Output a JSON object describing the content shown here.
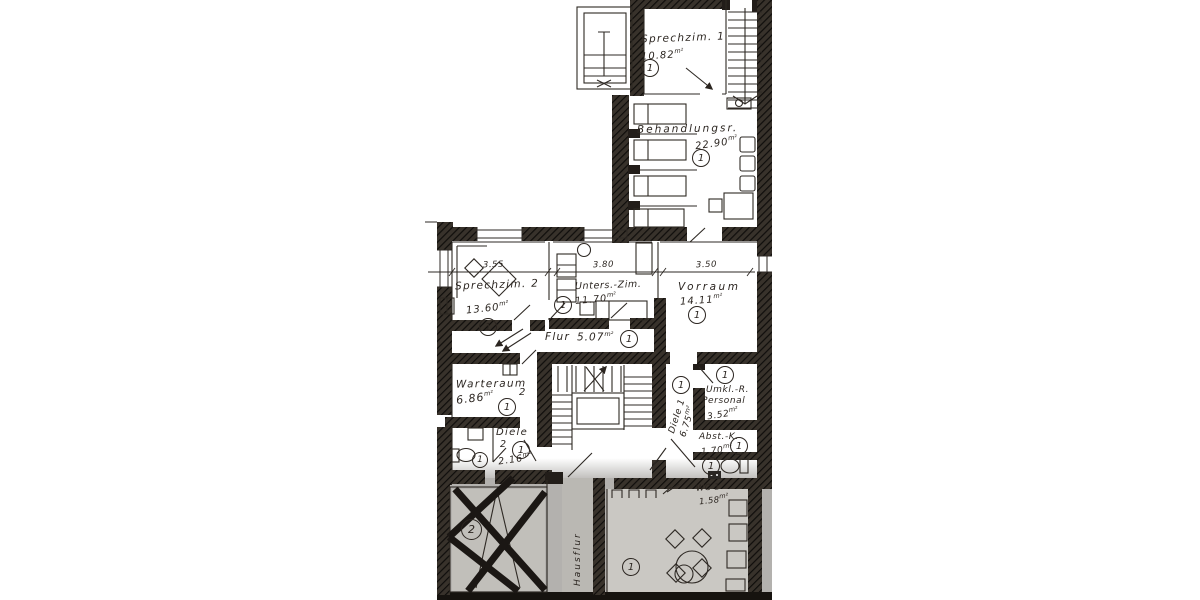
{
  "colors": {
    "ink": "#2b2520",
    "paper": "#ffffff",
    "scan_gray": "#b3b1ae"
  },
  "units": {
    "sqm": "m²"
  },
  "circles": {
    "one": "1",
    "two": "2"
  },
  "dims": {
    "sprechzim2": "3.55",
    "unters_zim": "3.80",
    "vorraum": "3.50"
  },
  "rooms": {
    "sprechzim1": {
      "label": "Sprechzim. 1",
      "area": "10.82"
    },
    "behandlungsr": {
      "label": "Behandlungsr.",
      "area": "22.90"
    },
    "sprechzim2": {
      "label": "Sprechzim. 2",
      "area": "13.60"
    },
    "unters_zim": {
      "label": "Unters.-Zim.",
      "area": "11.70"
    },
    "vorraum": {
      "label": "Vorraum",
      "area": "14.11"
    },
    "flur": {
      "label": "Flur",
      "area": "5.07"
    },
    "warteraum": {
      "label": "Warteraum",
      "number": "2",
      "area": "6.86"
    },
    "diele2": {
      "label": "Diele",
      "number": "2",
      "area": "2.16"
    },
    "diele1": {
      "label": "Diele 1",
      "area": "6.75"
    },
    "umkl": {
      "label": "Umkl.-R.",
      "label2": "Personal",
      "area": "3.52"
    },
    "abst": {
      "label": "Abst.-K.",
      "area": "1.70"
    },
    "wc1": {
      "label": "WC 1",
      "area": "1.58"
    },
    "hausflur": {
      "label": "Hausflur"
    }
  }
}
